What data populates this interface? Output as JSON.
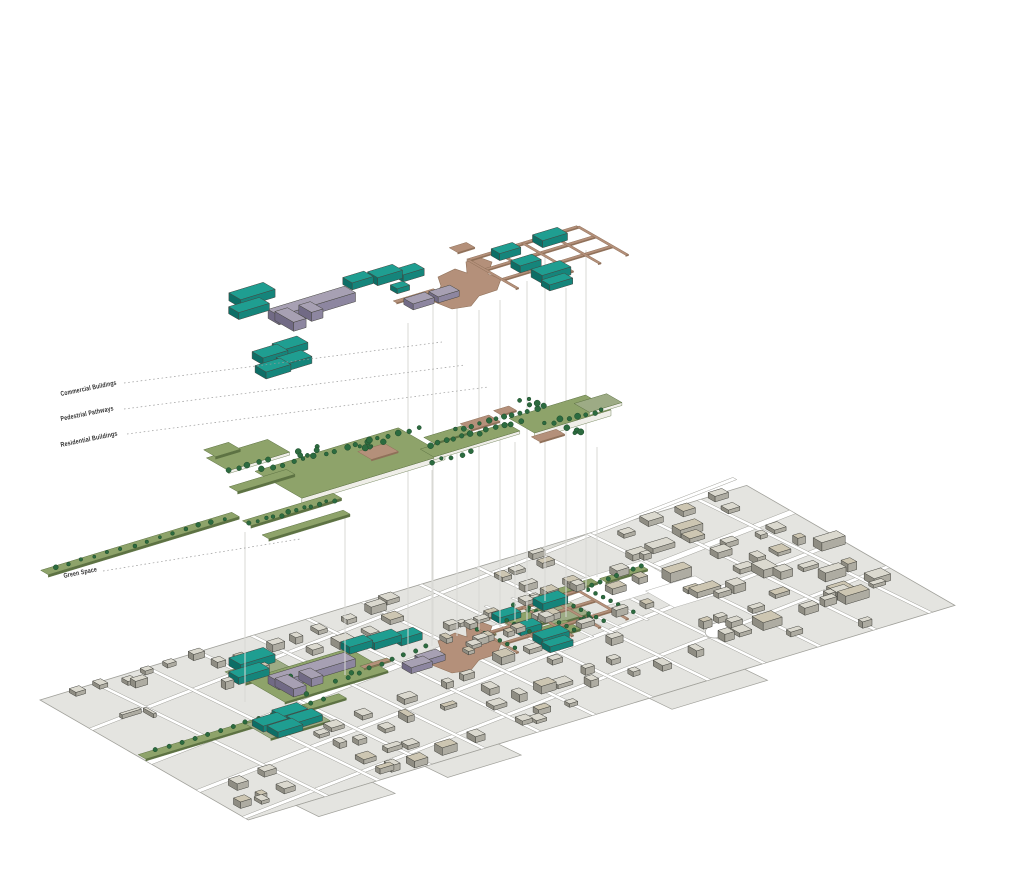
{
  "diagram": {
    "labels": {
      "commercial": "Commercial Buildings",
      "pathways": "Pedestrial Pathways",
      "residential": "Residential Buildings",
      "green": "Green Space"
    },
    "colors": {
      "bg": "#ffffff",
      "teal_top": "#1f9e91",
      "teal_side": "#15857b",
      "teal_dark": "#0d6e66",
      "purple_top": "#a7a0b3",
      "purple_side": "#8d86a0",
      "purple_dark": "#716a85",
      "tan": "#b4907a",
      "tan_side": "#8f7059",
      "olive": "#8ea36a",
      "olive_dim": "#9dab85",
      "olive_edge": "#5d7243",
      "slab_side": "#efeee8",
      "tree": "#2c6b3f",
      "tree_dark": "#1d4a2b",
      "base_fill": "#e4e4e0",
      "road": "#ffffff",
      "parcel_line": "#a0a09a",
      "bldg_top": "#dbd9cf",
      "bldg_beige": "#cdc6b2",
      "bldg_side": "#aeaca2",
      "bldg_dark": "#8f8d83",
      "outline": "#45453f",
      "connector": "#d9d9d5",
      "leader": "#9a9a9a",
      "label_text": "#333333"
    }
  }
}
